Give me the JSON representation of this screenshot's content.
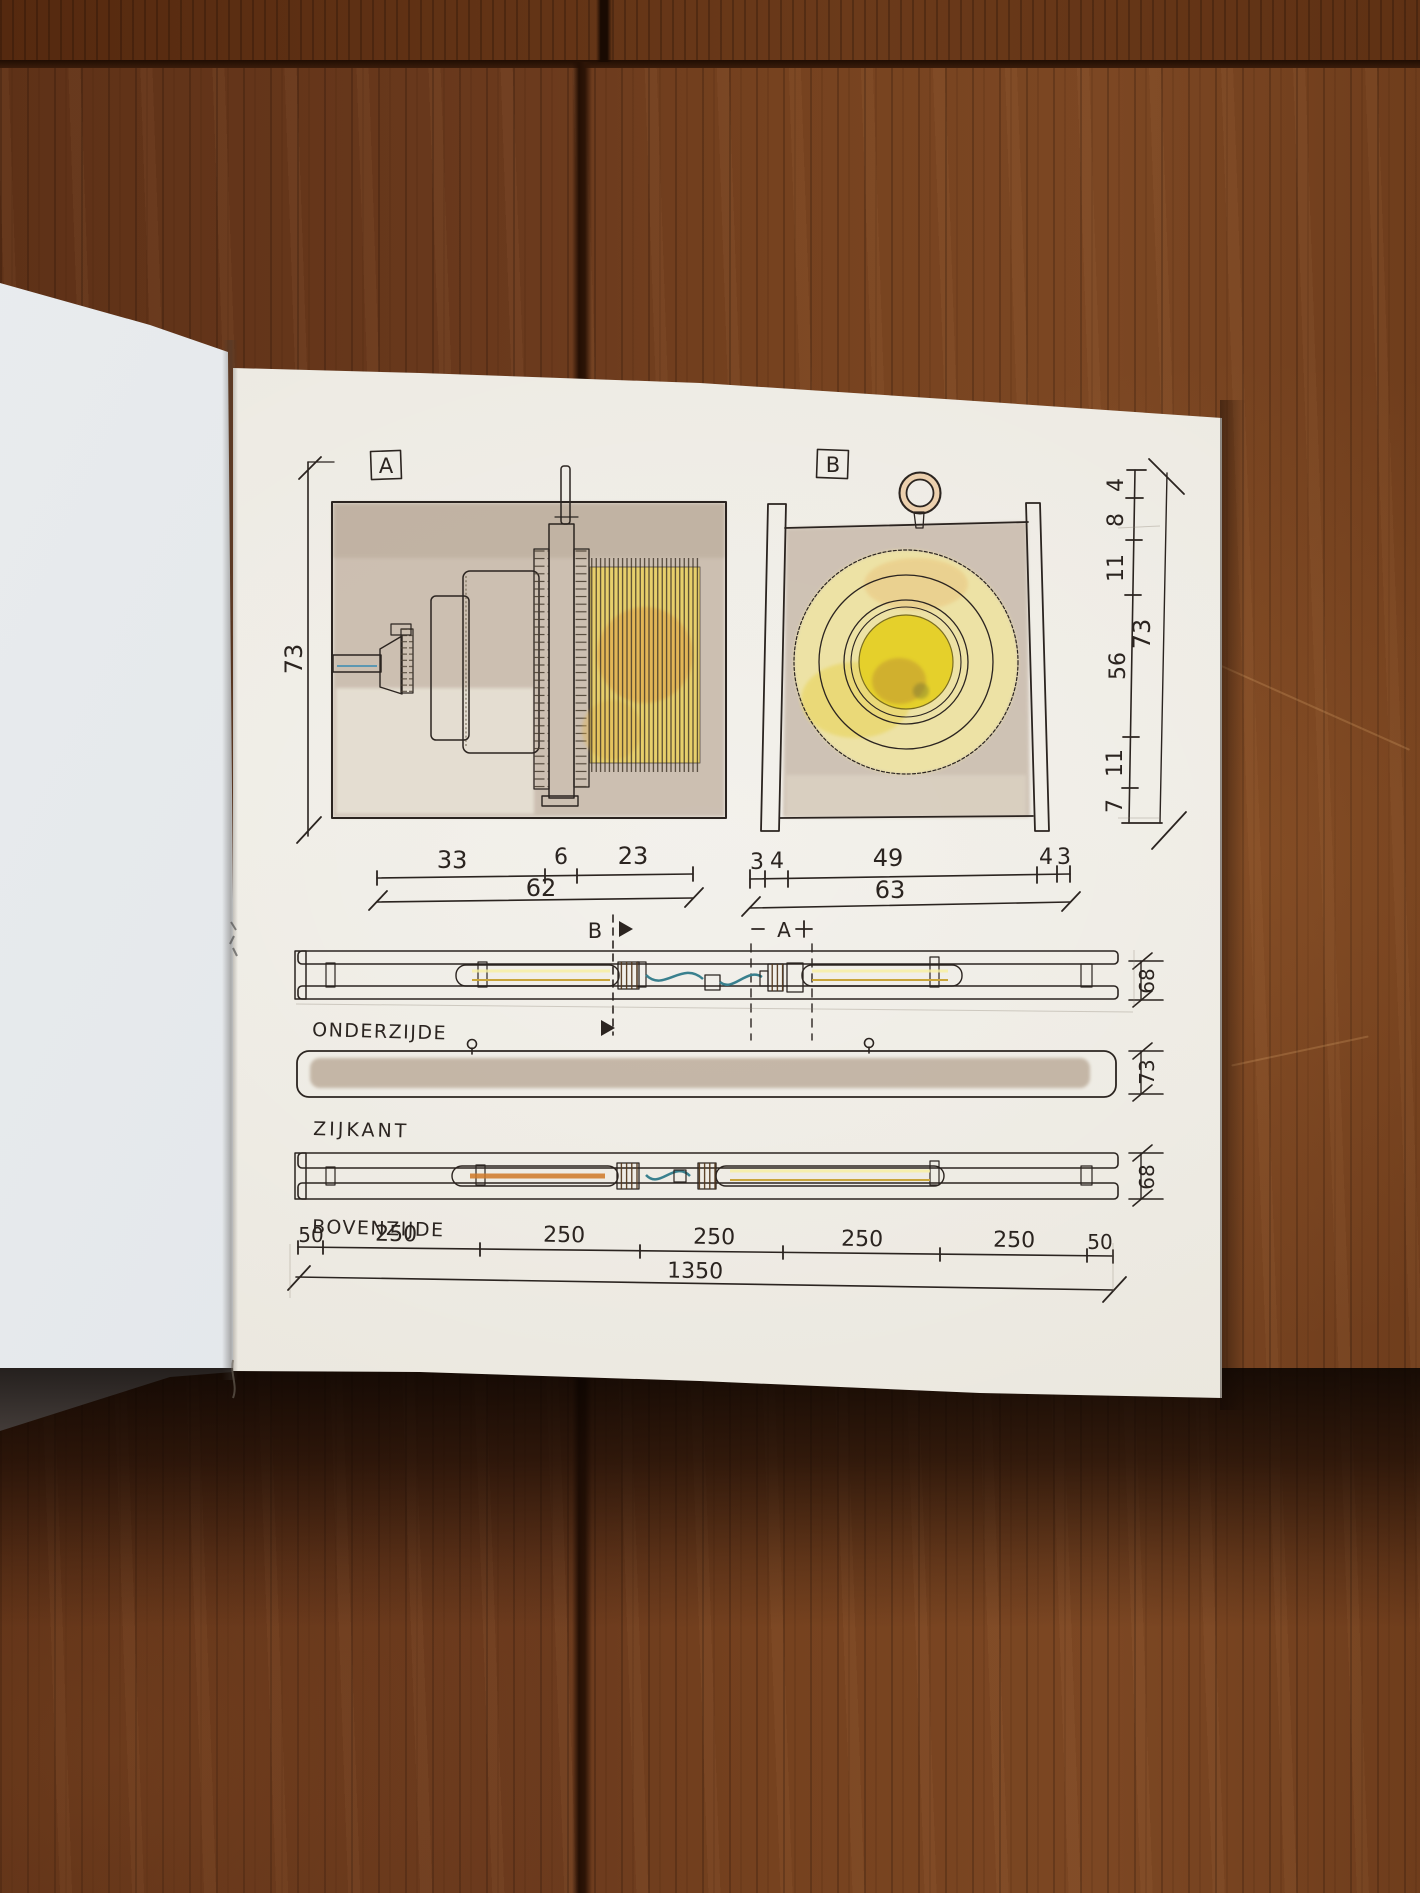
{
  "drawing": {
    "view_labels": {
      "a": "A",
      "b": "B"
    },
    "dim_left": "73",
    "under_a": {
      "segments": [
        "33",
        "6",
        "23"
      ],
      "total": "62"
    },
    "under_b": {
      "segments": [
        "3",
        "4",
        "49",
        "4",
        "3"
      ],
      "total": "63"
    },
    "right_column": {
      "segments": [
        "4",
        "8",
        "11",
        "56",
        "11",
        "7"
      ],
      "total": "73"
    },
    "section_a": "A",
    "section_b": "B",
    "views": [
      {
        "caption": "ONDERZIJDE",
        "side_dim": "68"
      },
      {
        "caption": "ZIJKANT",
        "side_dim": "73"
      },
      {
        "caption": "BOVENZIJDE",
        "side_dim": "68"
      }
    ],
    "bottom": {
      "segments": [
        "50",
        "250",
        "250",
        "250",
        "250",
        "250",
        "50"
      ],
      "total": "1350"
    }
  },
  "palette": {
    "wood": "#6b3a1d",
    "paper_right": "#edeae2",
    "paper_left": "#e2e6ea",
    "ink": "#2b2420",
    "wash_taupe": "#c6b7a8",
    "lamp_yellow": "#e8d44a",
    "pale_yellow": "#f0e5a4",
    "socket_orange": "#cf8a3d",
    "wire_teal": "#39808e",
    "pin_blue": "#7ab5ce",
    "ring_brass": "#ecd0ae"
  }
}
